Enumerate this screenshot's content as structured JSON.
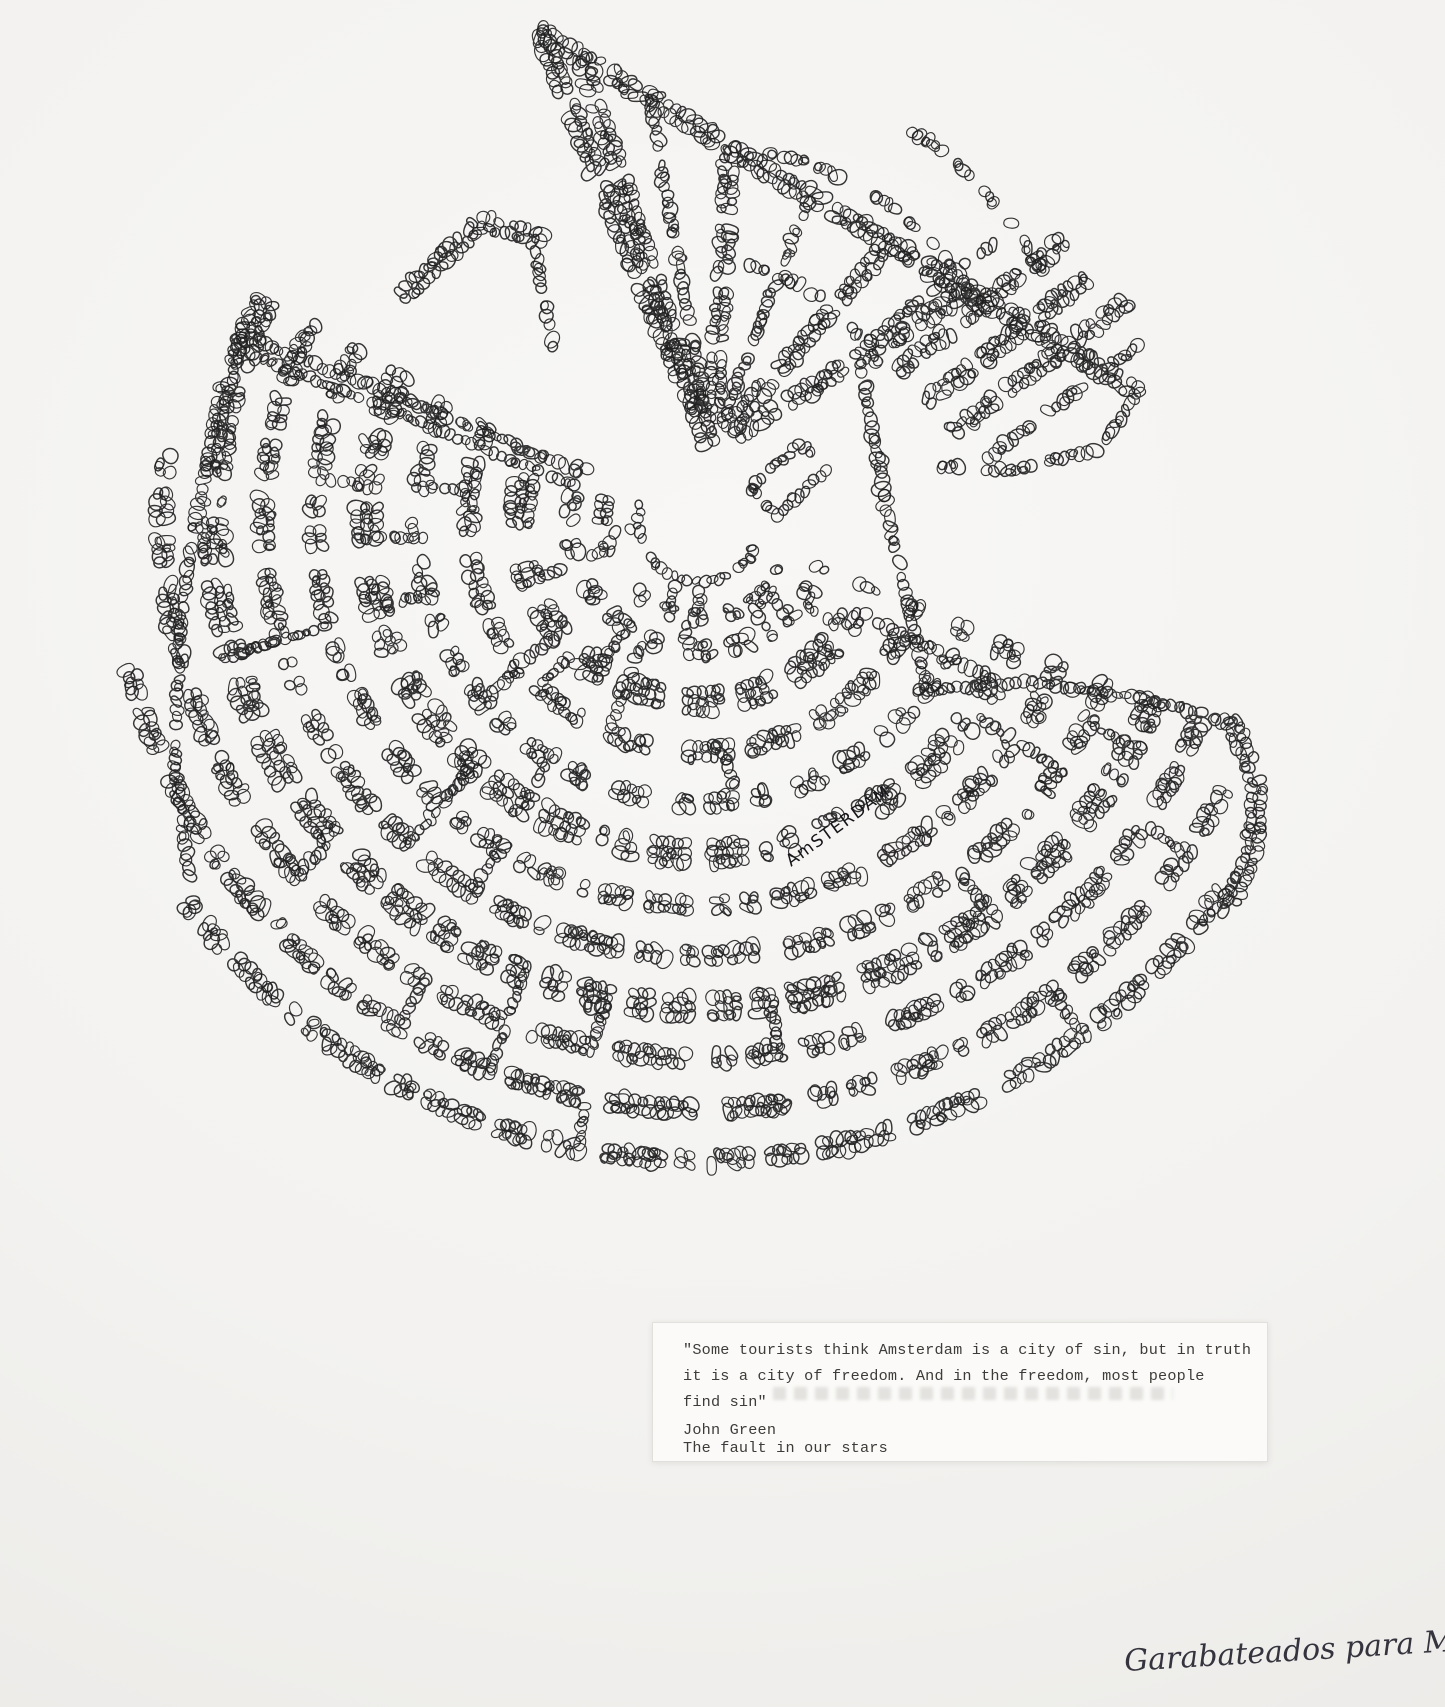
{
  "artwork": {
    "label": "AmSTERDAM",
    "ink_color": "#1b1b1d",
    "paper_color": "#f3f2f0",
    "drawing": {
      "seed": 1337,
      "fan": {
        "cx": 700,
        "cy": 520,
        "r_min": 130,
        "r_max": 640,
        "count": 11,
        "span": [
          22,
          207
        ],
        "core_rings": [
          62,
          97
        ],
        "left_clip": {
          "r0": 493,
          "r1": 620,
          "a0": 207,
          "a1": 152
        },
        "right_clip": {
          "r0": 560,
          "r1": 640,
          "a0": 22,
          "a1": 35
        }
      },
      "label_clearing": {
        "cx": 832,
        "cy": 840,
        "rx": 60,
        "ry": 17,
        "rot": -36
      },
      "triangle": {
        "apex": [
          712,
          448
        ],
        "street_span": [
          -85,
          -23
        ],
        "cross_arcs": [
          {
            "r": 185,
            "a0": -83,
            "a1": -26
          },
          {
            "r": 300,
            "a0": -79,
            "a1": -27
          },
          {
            "r": 375,
            "a0": -60,
            "a1": -27
          }
        ]
      },
      "strips": [
        {
          "pts": [
            [
              540,
              32
            ],
            [
              790,
              185
            ],
            [
              1040,
              332
            ]
          ],
          "rows": 2,
          "s": 6.5,
          "dash": [
            95,
            11
          ]
        },
        {
          "pts": [
            [
              1040,
              332
            ],
            [
              1138,
              392
            ]
          ],
          "rows": 2,
          "s": 6.5,
          "dash": null
        },
        {
          "pts": [
            [
              540,
              32
            ],
            [
              628,
              248
            ],
            [
              712,
              448
            ]
          ],
          "rows": 2,
          "s": 6.5,
          "dash": [
            80,
            12
          ]
        },
        {
          "pts": [
            [
              1138,
              392
            ],
            [
              1100,
              448
            ],
            [
              1020,
              470
            ],
            [
              940,
              468
            ]
          ],
          "rows": 1,
          "s": 6,
          "dash": [
            70,
            12
          ]
        },
        {
          "pts": [
            [
              699,
              409
            ],
            [
              580,
              56
            ]
          ],
          "rows": 2,
          "s": 6,
          "dash": [
            65,
            12
          ]
        },
        {
          "pts": [
            [
              706,
              413
            ],
            [
              650,
              98
            ]
          ],
          "rows": 1,
          "s": 6,
          "dash": [
            65,
            12
          ]
        },
        {
          "pts": [
            [
              714,
              418
            ],
            [
              730,
              146
            ]
          ],
          "rows": 2,
          "s": 6,
          "dash": [
            65,
            12
          ]
        },
        {
          "pts": [
            [
              722,
              423
            ],
            [
              810,
              194
            ]
          ],
          "rows": 1,
          "s": 6,
          "dash": [
            65,
            12
          ]
        },
        {
          "pts": [
            [
              730,
              428
            ],
            [
              890,
              242
            ]
          ],
          "rows": 2,
          "s": 6,
          "dash": [
            65,
            12
          ]
        },
        {
          "pts": [
            [
              738,
              433
            ],
            [
              970,
              290
            ]
          ],
          "rows": 2,
          "s": 6,
          "dash": [
            65,
            12
          ]
        },
        {
          "pts": [
            [
              900,
              368
            ],
            [
              1062,
              242
            ]
          ],
          "rows": 2,
          "s": 6,
          "dash": [
            60,
            12
          ]
        },
        {
          "pts": [
            [
              928,
              400
            ],
            [
              1095,
              272
            ]
          ],
          "rows": 2,
          "s": 6,
          "dash": [
            60,
            12
          ]
        },
        {
          "pts": [
            [
              956,
              430
            ],
            [
              1128,
              300
            ]
          ],
          "rows": 2,
          "s": 6,
          "dash": [
            60,
            12
          ]
        },
        {
          "pts": [
            [
              988,
              458
            ],
            [
              1150,
              335
            ]
          ],
          "rows": 1,
          "s": 6,
          "dash": [
            60,
            12
          ]
        },
        {
          "pts": [
            [
              870,
              340
            ],
            [
              1010,
              230
            ]
          ],
          "rows": 1,
          "s": 6,
          "dash": [
            60,
            12
          ]
        },
        {
          "pts": [
            [
              404,
              296
            ],
            [
              482,
              222
            ]
          ],
          "rows": 2,
          "s": 6,
          "dash": null
        },
        {
          "pts": [
            [
              482,
              222
            ],
            [
              548,
              240
            ]
          ],
          "rows": 2,
          "s": 6,
          "dash": null
        },
        {
          "pts": [
            [
              536,
              252
            ],
            [
              552,
              348
            ]
          ],
          "rows": 1,
          "s": 6,
          "dash": null
        }
      ],
      "chains": [
        {
          "pts": [
            [
              579,
              471
            ],
            [
              415,
              404
            ],
            [
              239,
              334
            ]
          ],
          "rows": 1,
          "s": 6,
          "dash": null
        },
        {
          "pts": [
            [
              574,
              485
            ],
            [
              410,
              418
            ],
            [
              234,
              348
            ]
          ],
          "rows": 1,
          "s": 5.5,
          "dash": null
        },
        {
          "pts": [
            [
              243,
              336
            ],
            [
              205,
              470
            ],
            [
              180,
              620
            ],
            [
              174,
              770
            ],
            [
              190,
              875
            ]
          ],
          "rows": 1,
          "s": 6,
          "dash": [
            85,
            12
          ]
        },
        {
          "pts": [
            [
              862,
              372
            ],
            [
              879,
              468
            ],
            [
              901,
              575
            ],
            [
              926,
              690
            ]
          ],
          "rows": 1,
          "s": 6.5,
          "dash": null
        },
        {
          "pts": [
            [
              926,
              690
            ],
            [
              1030,
              682
            ],
            [
              1140,
              698
            ],
            [
              1232,
              722
            ]
          ],
          "rows": 1,
          "s": 6,
          "dash": null
        },
        {
          "pts": [
            [
              1232,
              722
            ],
            [
              1257,
              782
            ],
            [
              1253,
              852
            ],
            [
              1224,
              918
            ]
          ],
          "rows": 2,
          "s": 6,
          "dash": null
        },
        {
          "pts": [
            [
              751,
              489
            ],
            [
              800,
              443
            ],
            [
              826,
              470
            ],
            [
              777,
              516
            ],
            [
              751,
              489
            ]
          ],
          "rows": 1,
          "s": 5.5,
          "dash": null
        }
      ]
    }
  },
  "quote_card": {
    "lines": [
      "\"Some tourists think Amsterdam is a city of sin, but in truth",
      "it is a city of freedom. And in the freedom, most people",
      "find sin\""
    ],
    "attribution_name": "John Green",
    "attribution_work": "The fault in our stars"
  },
  "signature": {
    "text": "Garabateados para Mínimae"
  }
}
